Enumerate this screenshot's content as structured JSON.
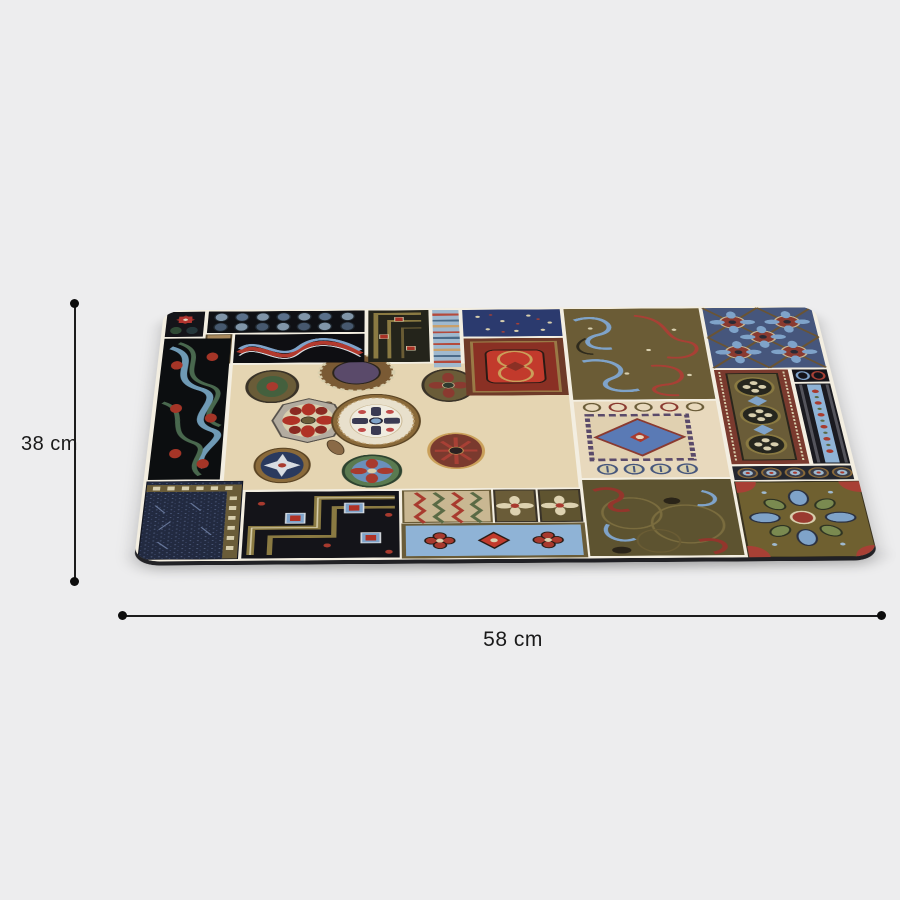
{
  "page": {
    "type": "product-photo-with-dimensions",
    "background_color": "#ededee"
  },
  "product": {
    "name": "patchwork-ornament-mat",
    "description": "Rectangular mat with multicolor vintage ornament patchwork print, shown tilted in perspective with rounded corners"
  },
  "dimensions": {
    "height": {
      "label": "38 cm",
      "value": 38,
      "unit": "cm"
    },
    "width": {
      "label": "58 cm",
      "value": 58,
      "unit": "cm"
    }
  },
  "annotation_style": {
    "line_color": "#1c1c1c",
    "endpoint_dot_color": "#0d0d0d",
    "text_color": "#1a1a1a"
  },
  "mat_palette": {
    "grout": "#f3eee1",
    "cream_panel": "#e5d5b2",
    "black_tile": "#141419",
    "navy_carpet": "#222a40",
    "olive": "#6a5c38",
    "olive_gold": "#8a7a42",
    "brick_red": "#a83a2e",
    "deep_red": "#7a3a2e",
    "steel_blue": "#7fa3c9",
    "slate_blue": "#46567c",
    "sage_green": "#5a6a45",
    "tan": "#c9b792"
  },
  "mat_tiles": [
    "star-tile",
    "pinecone-leaves-tile",
    "wavy-ribbon-tile",
    "greek-key-corner-tile",
    "stripe-band-tile",
    "navy-floral-tile",
    "red-celtic-tile",
    "olive-arabesque-tile",
    "blue-kaleidoscope-tile",
    "paisley-wave-tile",
    "cream-medallion-panel",
    "cream-ornate-tile",
    "clover-band-tile",
    "striped-panel-tile",
    "circle-strip-tile",
    "olive-flower-tile",
    "brown-marbled-tile",
    "navy-carpet-tile",
    "greek-key-tile",
    "chevron-tile",
    "small-flower-tiles",
    "blue-flower-strip"
  ]
}
